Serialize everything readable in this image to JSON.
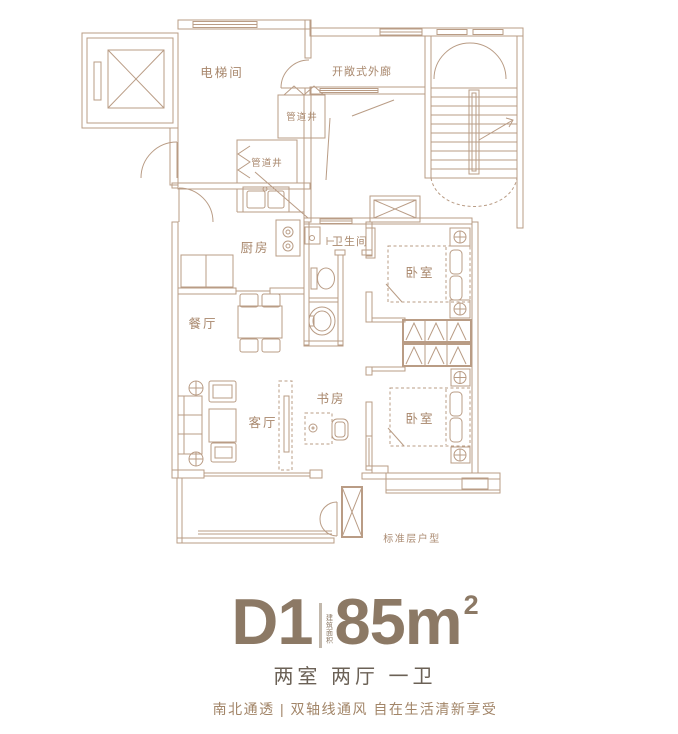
{
  "floorplan": {
    "caption": "标准层户型",
    "labels": {
      "elevator_hall": "电梯间",
      "open_corridor": "开敞式外廊",
      "pipe_shaft_top": "管道井",
      "pipe_shaft_mid": "管道井",
      "kitchen": "厨房",
      "bathroom": "卫生间",
      "bedroom_north": "卧室",
      "bedroom_south": "卧室",
      "dining": "餐厅",
      "living": "客厅",
      "study": "书房"
    },
    "colors": {
      "line": "#b99c85",
      "room_label": "#a8876c"
    }
  },
  "unit_info": {
    "unit_code": "D1",
    "area_label_vertical": "建筑面积",
    "area_value": "85m",
    "area_superscript": "2",
    "layout_summary": "两室 两厅 一卫",
    "tagline": "南北通透 | 双轴线通风 自在生活清新享受",
    "colors": {
      "title": "#8c7965",
      "summary": "#6b6156",
      "tagline": "#a28568"
    }
  }
}
